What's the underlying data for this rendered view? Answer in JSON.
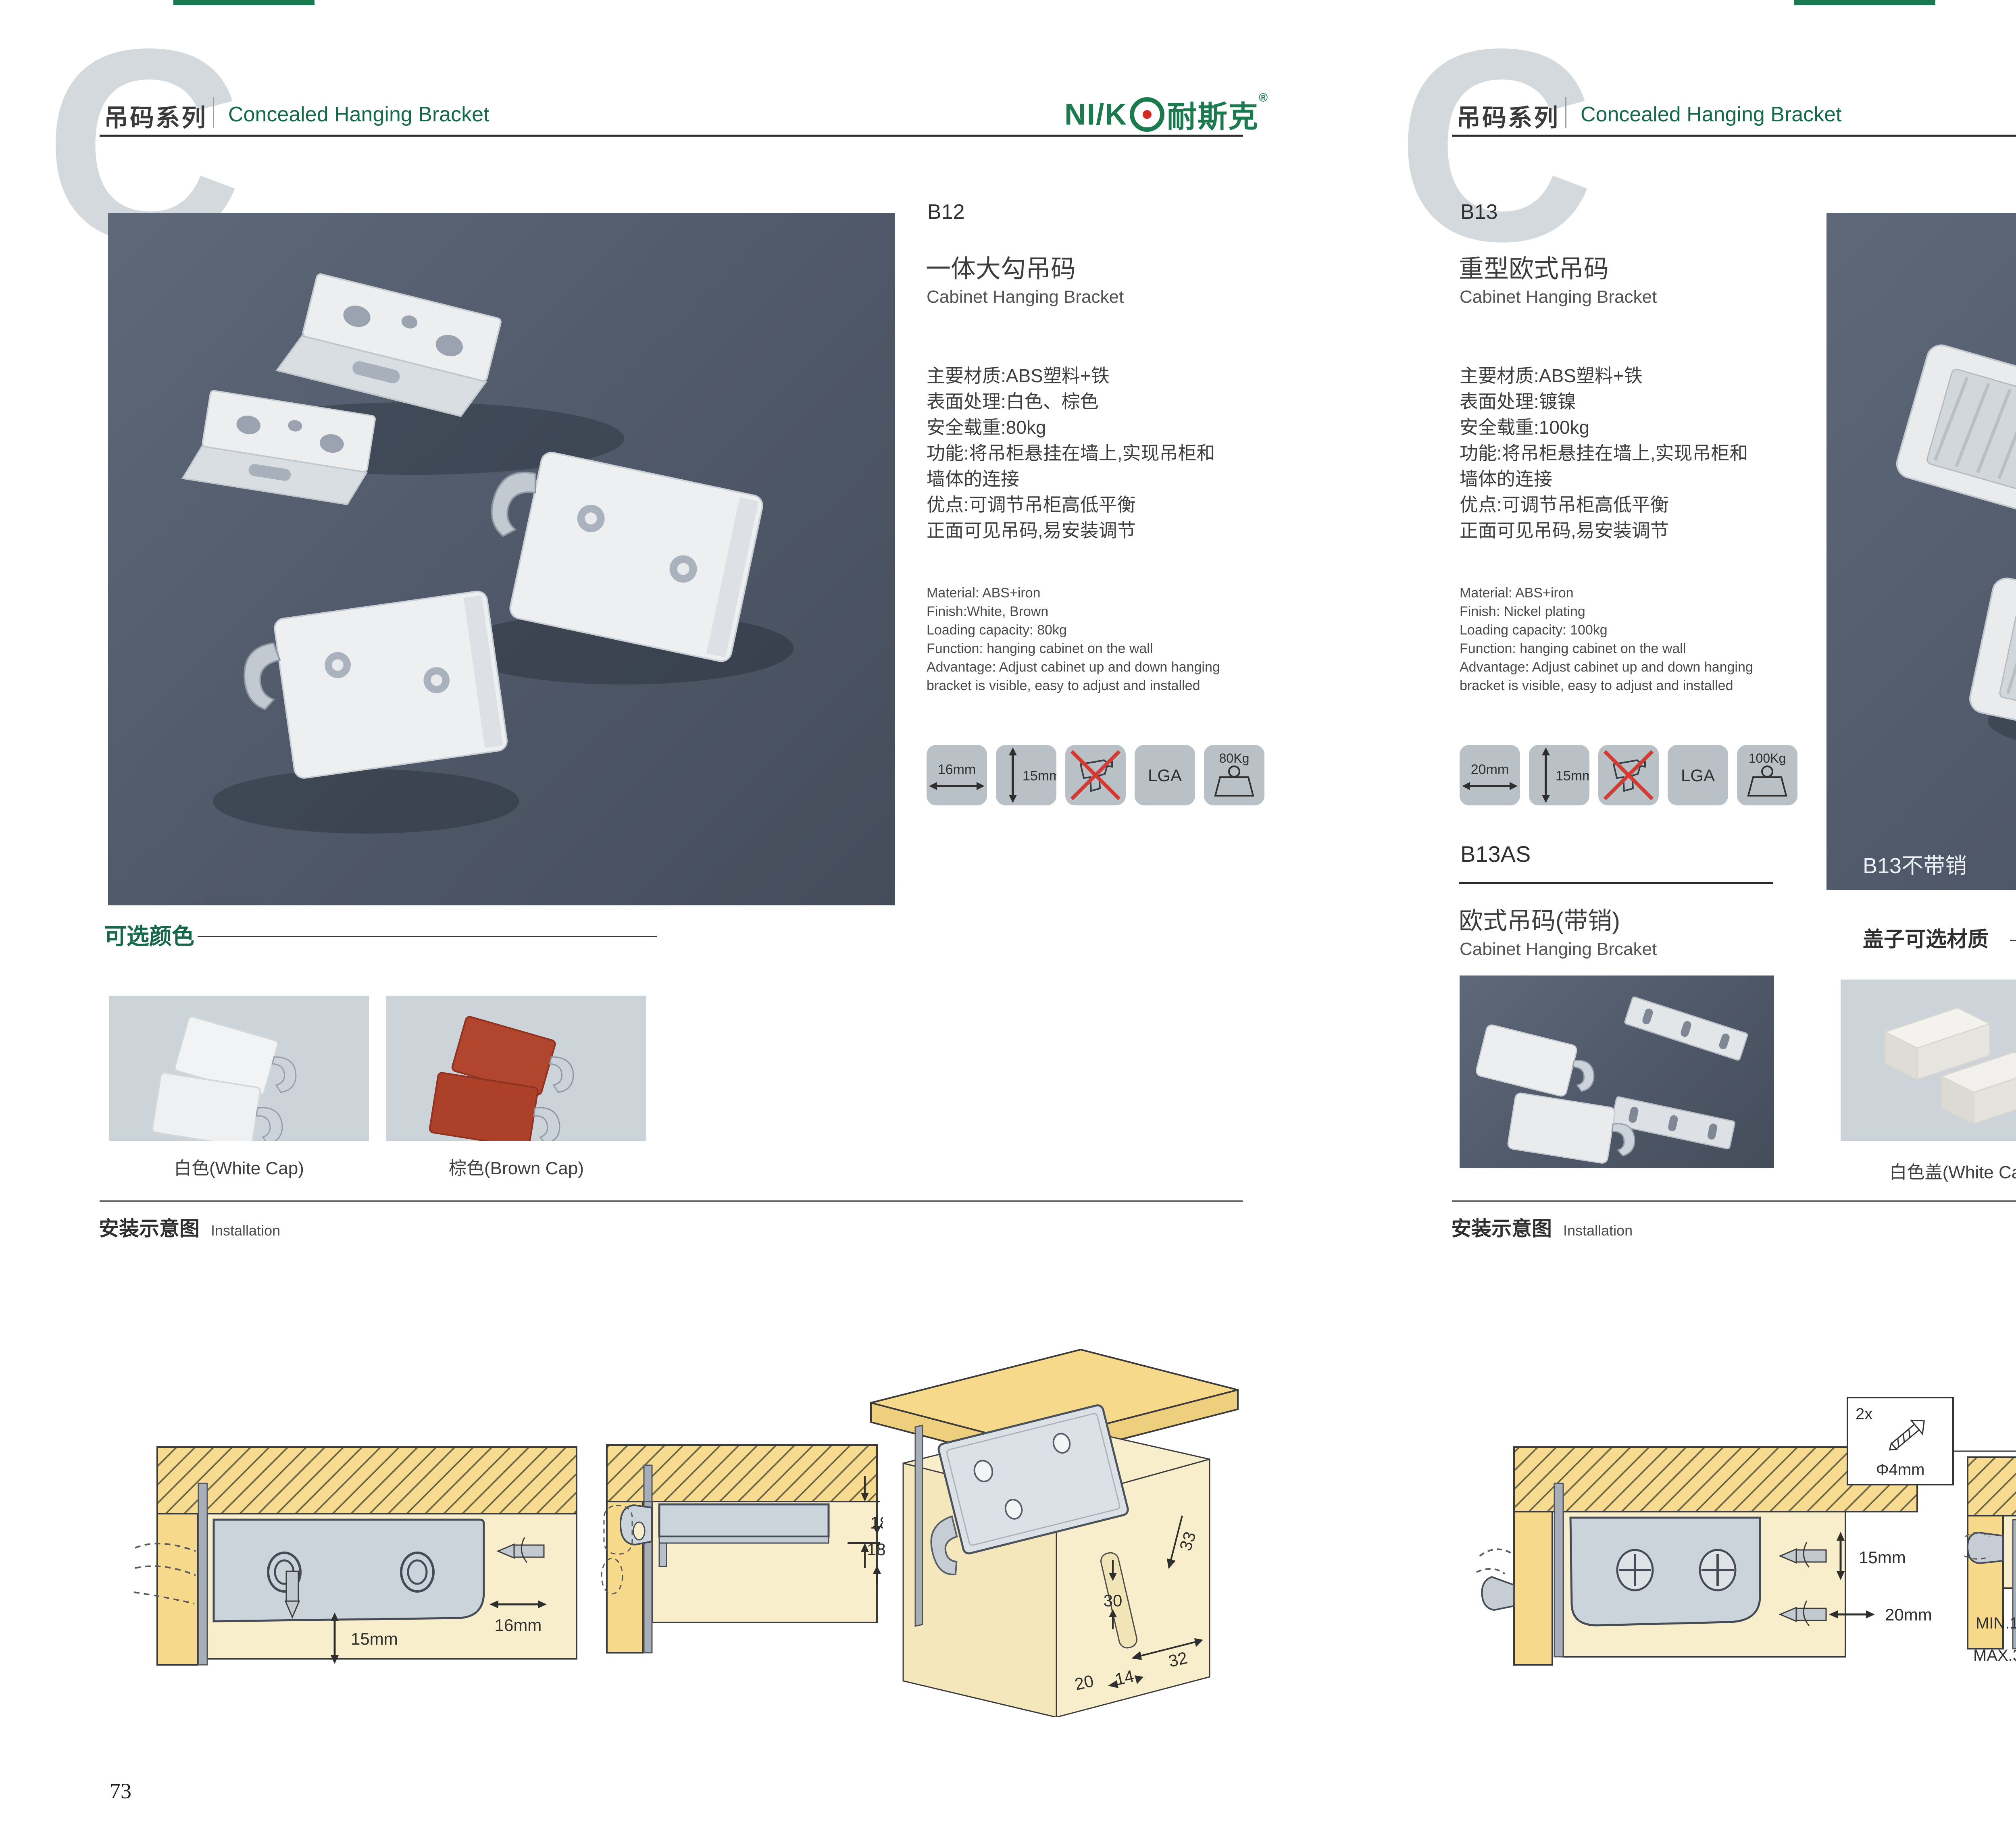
{
  "header": {
    "watermark": "C",
    "series_cn": "吊码系列",
    "series_en": "Concealed Hanging Bracket",
    "logo_latin": "NI/K",
    "logo_cn": "耐斯克",
    "logo_reg": "®"
  },
  "left": {
    "product": {
      "code": "B12",
      "name_cn": "一体大勾吊码",
      "name_en": "Cabinet Hanging Bracket",
      "specs_cn": [
        "主要材质:ABS塑料+铁",
        "表面处理:白色、棕色",
        "安全载重:80kg",
        "功能:将吊柜悬挂在墙上,实现吊柜和",
        "墙体的连接",
        "优点:可调节吊柜高低平衡",
        "正面可见吊码,易安装调节"
      ],
      "specs_en": [
        "Material: ABS+iron",
        "Finish:White, Brown",
        "Loading capacity: 80kg",
        "Function: hanging cabinet on the wall",
        "Advantage: Adjust cabinet up and down hanging",
        "bracket is visible, easy to adjust and installed"
      ],
      "icons": {
        "width": "16mm",
        "height": "15mm",
        "cert": "LGA",
        "load": "80Kg"
      }
    },
    "colors": {
      "title": "可选颜色",
      "option1": "白色(White Cap)",
      "option2": "棕色(Brown Cap)"
    },
    "install": {
      "title_cn": "安装示意图",
      "title_en": "Installation"
    },
    "d1": {
      "dim_h": "16mm",
      "dim_v": "15mm"
    },
    "d2": {
      "dim": "18"
    },
    "d3": {
      "d18": "18",
      "d33": "33",
      "d30": "30",
      "d32": "32",
      "d20": "20",
      "d14": "14"
    },
    "page_no": "73"
  },
  "right": {
    "product": {
      "code": "B13",
      "name_cn": "重型欧式吊码",
      "name_en": "Cabinet Hanging Bracket",
      "specs_cn": [
        "主要材质:ABS塑料+铁",
        "表面处理:镀镍",
        "安全载重:100kg",
        "功能:将吊柜悬挂在墙上,实现吊柜和",
        "墙体的连接",
        "优点:可调节吊柜高低平衡",
        "正面可见吊码,易安装调节"
      ],
      "specs_en": [
        "Material: ABS+iron",
        "Finish: Nickel plating",
        "Loading capacity: 100kg",
        "Function: hanging cabinet on the wall",
        "Advantage: Adjust cabinet up and down hanging",
        "bracket is visible, easy to adjust and installed"
      ],
      "icons": {
        "width": "20mm",
        "height": "15mm",
        "cert": "LGA",
        "load": "100Kg"
      }
    },
    "photo_label": "B13不带销",
    "b13as": {
      "code": "B13AS",
      "name_cn": "欧式吊码(带销)",
      "name_en": "Cabinet Hanging Brcaket"
    },
    "caps": {
      "title": "盖子可选材质",
      "option1": "白色盖(White Cap)",
      "option2": "灰色盖(Gray Cap)"
    },
    "install": {
      "title_cn": "安装示意图",
      "title_en": "Installation"
    },
    "d1": {
      "dim_v": "15mm",
      "dim_h": "20mm",
      "box_qty": "2x",
      "box_dia": "Φ4mm"
    },
    "d2": {
      "min": "MIN.15",
      "max": "MAX.35",
      "w": "58",
      "t": "18"
    },
    "d3": {
      "d16": "16",
      "d40": "40",
      "rmax": "RMAX4",
      "d19": "19",
      "d32": "32",
      "d18": "18"
    },
    "page_no": "74"
  }
}
